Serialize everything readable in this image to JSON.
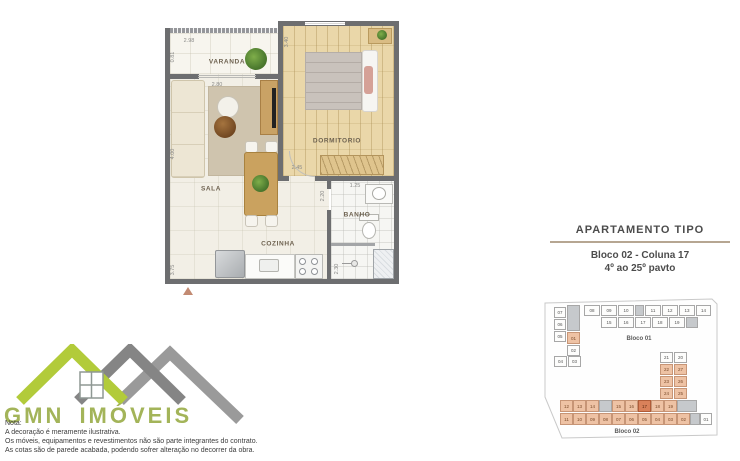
{
  "plan": {
    "labels": {
      "varanda": "VARANDA",
      "dormitorio": "DORMITORIO",
      "sala": "SALA",
      "banho": "BANHO",
      "cozinha": "COZINHA"
    },
    "dimensions": [
      {
        "t": "2.98",
        "x": 24,
        "y": 29,
        "r": 0
      },
      {
        "t": "0.81",
        "x": 8,
        "y": 45,
        "r": 1
      },
      {
        "t": "3.40",
        "x": 122,
        "y": 30,
        "r": 1
      },
      {
        "t": "2.80",
        "x": 52,
        "y": 73,
        "r": 0
      },
      {
        "t": "4.00",
        "x": 8,
        "y": 142,
        "r": 1
      },
      {
        "t": "2.45",
        "x": 132,
        "y": 156,
        "r": 0
      },
      {
        "t": "2.20",
        "x": 158,
        "y": 184,
        "r": 1
      },
      {
        "t": "1.25",
        "x": 190,
        "y": 174,
        "r": 0
      },
      {
        "t": "2.30",
        "x": 172,
        "y": 257,
        "r": 1
      },
      {
        "t": "3.75",
        "x": 8,
        "y": 258,
        "r": 1
      }
    ]
  },
  "info_panel": {
    "title": "APARTAMENTO TIPO",
    "unit": "Bloco 02 - Coluna 17",
    "floors": "4º ao 25º pavto"
  },
  "site_map": {
    "bloco01": {
      "label": "Bloco 01",
      "cells": [
        {
          "n": "07",
          "x": 12,
          "y": 15,
          "w": 12,
          "h": 11,
          "t": "w"
        },
        {
          "n": "06",
          "x": 12,
          "y": 27,
          "w": 12,
          "h": 11,
          "t": "w"
        },
        {
          "n": "05",
          "x": 12,
          "y": 39,
          "w": 12,
          "h": 11,
          "t": "w"
        },
        {
          "n": "",
          "x": 25,
          "y": 13,
          "w": 13,
          "h": 26,
          "t": "g"
        },
        {
          "n": "01",
          "x": 25,
          "y": 40,
          "w": 13,
          "h": 12,
          "t": "o"
        },
        {
          "n": "02",
          "x": 25,
          "y": 53,
          "w": 13,
          "h": 11,
          "t": "w"
        },
        {
          "n": "04",
          "x": 12,
          "y": 64,
          "w": 13,
          "h": 11,
          "t": "w"
        },
        {
          "n": "03",
          "x": 26,
          "y": 64,
          "w": 13,
          "h": 11,
          "t": "w"
        },
        {
          "n": "08",
          "x": 42,
          "y": 13,
          "w": 16,
          "h": 11,
          "t": "w"
        },
        {
          "n": "09",
          "x": 59,
          "y": 13,
          "w": 16,
          "h": 11,
          "t": "w"
        },
        {
          "n": "10",
          "x": 76,
          "y": 13,
          "w": 16,
          "h": 11,
          "t": "w"
        },
        {
          "n": "",
          "x": 93,
          "y": 13,
          "w": 9,
          "h": 11,
          "t": "g"
        },
        {
          "n": "11",
          "x": 103,
          "y": 13,
          "w": 16,
          "h": 11,
          "t": "w"
        },
        {
          "n": "12",
          "x": 120,
          "y": 13,
          "w": 16,
          "h": 11,
          "t": "w"
        },
        {
          "n": "13",
          "x": 137,
          "y": 13,
          "w": 16,
          "h": 11,
          "t": "w"
        },
        {
          "n": "14",
          "x": 154,
          "y": 13,
          "w": 15,
          "h": 11,
          "t": "w"
        },
        {
          "n": "15",
          "x": 59,
          "y": 25,
          "w": 16,
          "h": 11,
          "t": "w"
        },
        {
          "n": "16",
          "x": 76,
          "y": 25,
          "w": 16,
          "h": 11,
          "t": "w"
        },
        {
          "n": "17",
          "x": 93,
          "y": 25,
          "w": 16,
          "h": 11,
          "t": "w"
        },
        {
          "n": "18",
          "x": 110,
          "y": 25,
          "w": 16,
          "h": 11,
          "t": "w"
        },
        {
          "n": "19",
          "x": 127,
          "y": 25,
          "w": 16,
          "h": 11,
          "t": "w"
        },
        {
          "n": "",
          "x": 144,
          "y": 25,
          "w": 12,
          "h": 11,
          "t": "g"
        }
      ]
    },
    "bloco02": {
      "label": "Bloco 02",
      "cells": [
        {
          "n": "21",
          "x": 118,
          "y": 60,
          "w": 13,
          "h": 11,
          "t": "w"
        },
        {
          "n": "20",
          "x": 132,
          "y": 60,
          "w": 13,
          "h": 11,
          "t": "w"
        },
        {
          "n": "22",
          "x": 118,
          "y": 72,
          "w": 13,
          "h": 11,
          "t": "o"
        },
        {
          "n": "27",
          "x": 132,
          "y": 72,
          "w": 13,
          "h": 11,
          "t": "o"
        },
        {
          "n": "23",
          "x": 118,
          "y": 84,
          "w": 13,
          "h": 11,
          "t": "o"
        },
        {
          "n": "26",
          "x": 132,
          "y": 84,
          "w": 13,
          "h": 11,
          "t": "o"
        },
        {
          "n": "24",
          "x": 118,
          "y": 96,
          "w": 13,
          "h": 11,
          "t": "o"
        },
        {
          "n": "25",
          "x": 132,
          "y": 96,
          "w": 13,
          "h": 11,
          "t": "o"
        },
        {
          "n": "12",
          "x": 18,
          "y": 108,
          "w": 13,
          "h": 12,
          "t": "o"
        },
        {
          "n": "13",
          "x": 31,
          "y": 108,
          "w": 13,
          "h": 12,
          "t": "o"
        },
        {
          "n": "14",
          "x": 44,
          "y": 108,
          "w": 13,
          "h": 12,
          "t": "o"
        },
        {
          "n": "",
          "x": 57,
          "y": 108,
          "w": 13,
          "h": 12,
          "t": "g"
        },
        {
          "n": "15",
          "x": 70,
          "y": 108,
          "w": 13,
          "h": 12,
          "t": "o"
        },
        {
          "n": "16",
          "x": 83,
          "y": 108,
          "w": 13,
          "h": 12,
          "t": "o"
        },
        {
          "n": "17",
          "x": 96,
          "y": 108,
          "w": 13,
          "h": 12,
          "t": "hl"
        },
        {
          "n": "18",
          "x": 109,
          "y": 108,
          "w": 13,
          "h": 12,
          "t": "o"
        },
        {
          "n": "19",
          "x": 122,
          "y": 108,
          "w": 13,
          "h": 12,
          "t": "o"
        },
        {
          "n": "",
          "x": 135,
          "y": 108,
          "w": 20,
          "h": 12,
          "t": "g"
        },
        {
          "n": "11",
          "x": 18,
          "y": 121,
          "w": 13,
          "h": 12,
          "t": "o"
        },
        {
          "n": "10",
          "x": 31,
          "y": 121,
          "w": 13,
          "h": 12,
          "t": "o"
        },
        {
          "n": "09",
          "x": 44,
          "y": 121,
          "w": 13,
          "h": 12,
          "t": "o"
        },
        {
          "n": "08",
          "x": 57,
          "y": 121,
          "w": 13,
          "h": 12,
          "t": "o"
        },
        {
          "n": "07",
          "x": 70,
          "y": 121,
          "w": 13,
          "h": 12,
          "t": "o"
        },
        {
          "n": "06",
          "x": 83,
          "y": 121,
          "w": 13,
          "h": 12,
          "t": "o"
        },
        {
          "n": "05",
          "x": 96,
          "y": 121,
          "w": 13,
          "h": 12,
          "t": "o"
        },
        {
          "n": "04",
          "x": 109,
          "y": 121,
          "w": 13,
          "h": 12,
          "t": "o"
        },
        {
          "n": "03",
          "x": 122,
          "y": 121,
          "w": 13,
          "h": 12,
          "t": "o"
        },
        {
          "n": "02",
          "x": 135,
          "y": 121,
          "w": 13,
          "h": 12,
          "t": "o"
        },
        {
          "n": "",
          "x": 148,
          "y": 121,
          "w": 10,
          "h": 12,
          "t": "g"
        },
        {
          "n": "01",
          "x": 158,
          "y": 121,
          "w": 12,
          "h": 12,
          "t": "w"
        }
      ]
    }
  },
  "logo": {
    "brand": "GMN IMÓVEIS"
  },
  "notes": {
    "title": "Nota:",
    "lines": [
      "A decoração é meramente ilustrativa.",
      "Os móveis, equipamentos e revestimentos não são parte integrantes do contrato.",
      "As cotas são de parede acabada, podendo sofrer alteração no decorrer da obra."
    ]
  },
  "colors": {
    "wall_gray": "#6d6e70",
    "accent_green": "#aec93c",
    "unit_orange": "#eec2a4",
    "highlight_orange": "#d9815a"
  }
}
